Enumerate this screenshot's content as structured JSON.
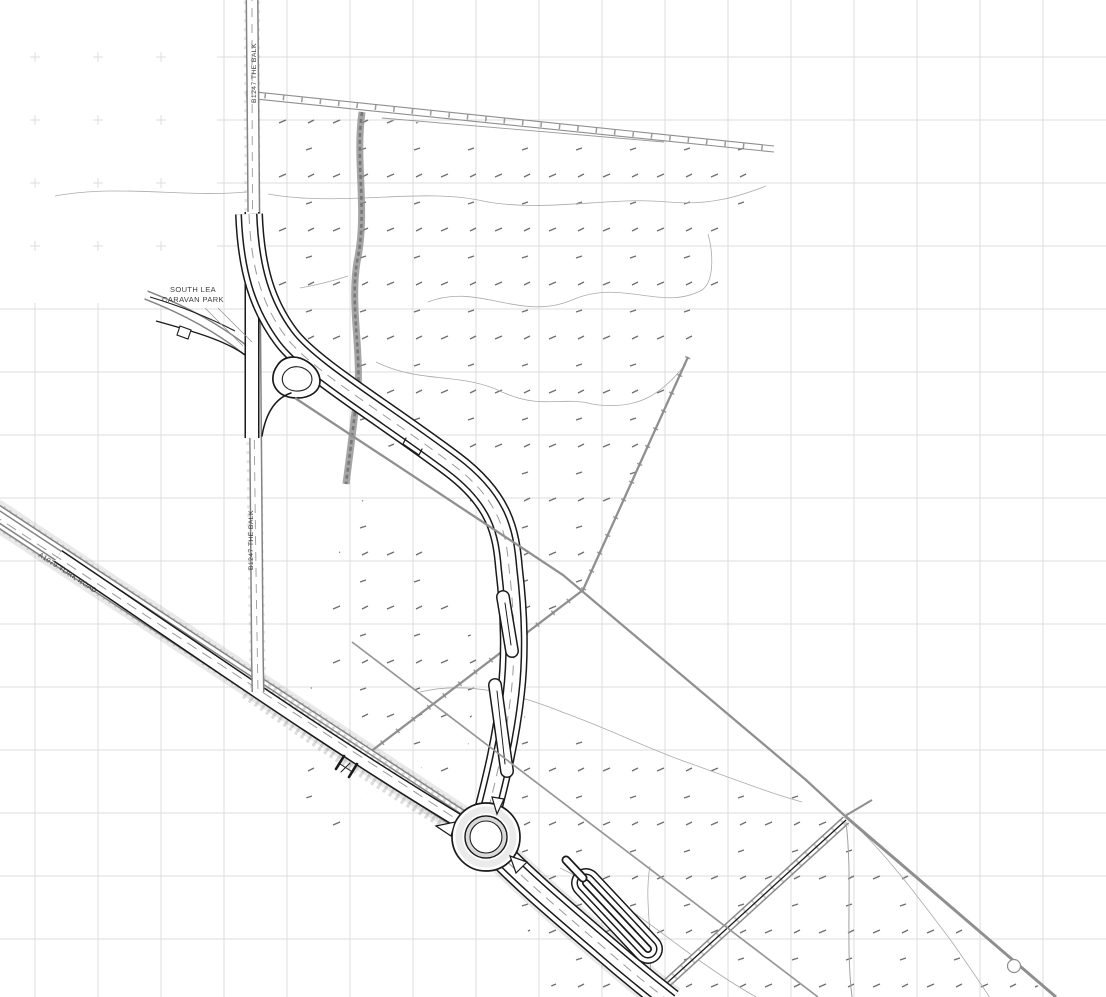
{
  "plan": {
    "labels": {
      "caravan_park_line1": "SOUTH LEA",
      "caravan_park_line2": "CARAVAN PARK",
      "b1247_top": "B1247 THE BALK",
      "b1247_mid": "B1247 THE BALK",
      "a1079": "A1079 YORK ROAD"
    },
    "colors": {
      "background": "#ffffff",
      "grid_line": "#dcdcdc",
      "existing_feature": "#8a8a8a",
      "proposed_work": "#1a1a1a",
      "contour_line": "#ababab",
      "label_text": "#3c3c3c"
    }
  }
}
